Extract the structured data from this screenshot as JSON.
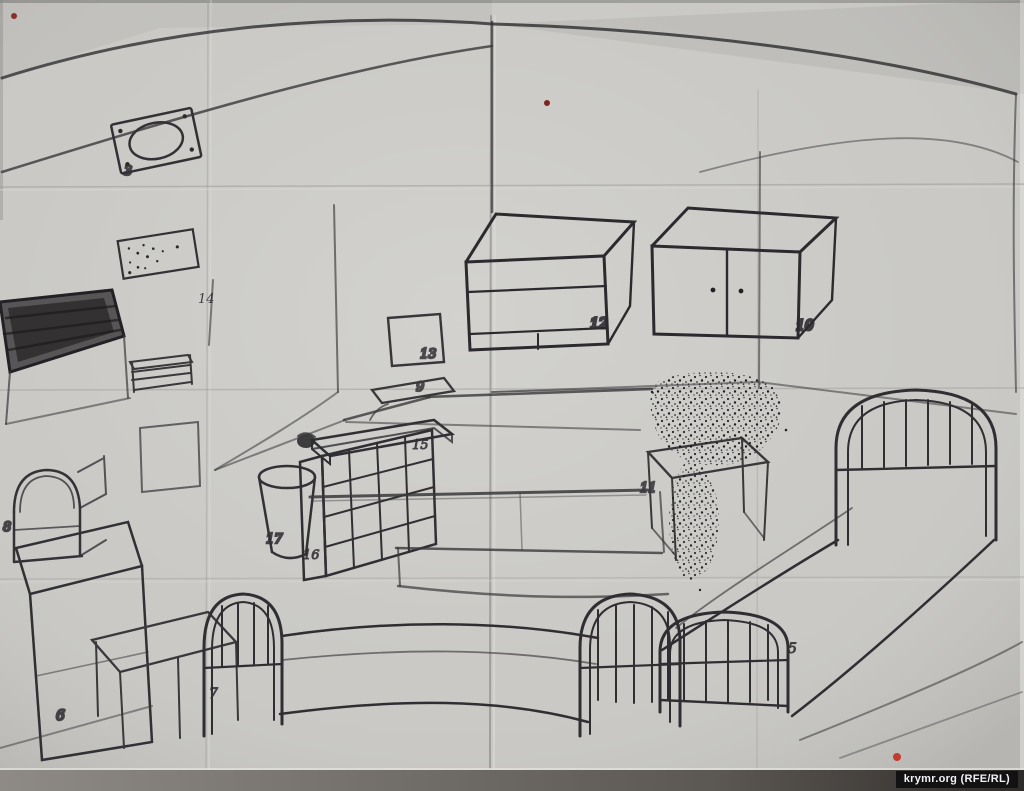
{
  "meta": {
    "description": "Scanned hand-drawn pencil sketch of a cell/barrack room interior on creased paper, with numbered furniture"
  },
  "watermark": {
    "text": "krymr.org (RFE/RL)"
  },
  "item_labels": {
    "oval_plate": "3",
    "vent_plate": "14",
    "wall_square": "13",
    "small_wall_shelf": "9",
    "shelf_slab": "15",
    "cubby_shelf": "16",
    "bucket": "17",
    "cabinet_open": "12",
    "cabinet_doors": "10",
    "stool": "11",
    "bed_right": "5",
    "bed_front": "7",
    "pedestal": "6",
    "dome_box": "8"
  },
  "colors": {
    "paper": "#cac9c5",
    "pencil": "#3a383b",
    "pencil_dark": "#232125",
    "red_dot_small": "#7e2420",
    "red_dot_mid": "#8a2f2b",
    "red_dot_bright": "#c43a2e",
    "scan_band": "#57534f",
    "watermark_bg": "#121212",
    "watermark_text": "#f2f2f2"
  }
}
